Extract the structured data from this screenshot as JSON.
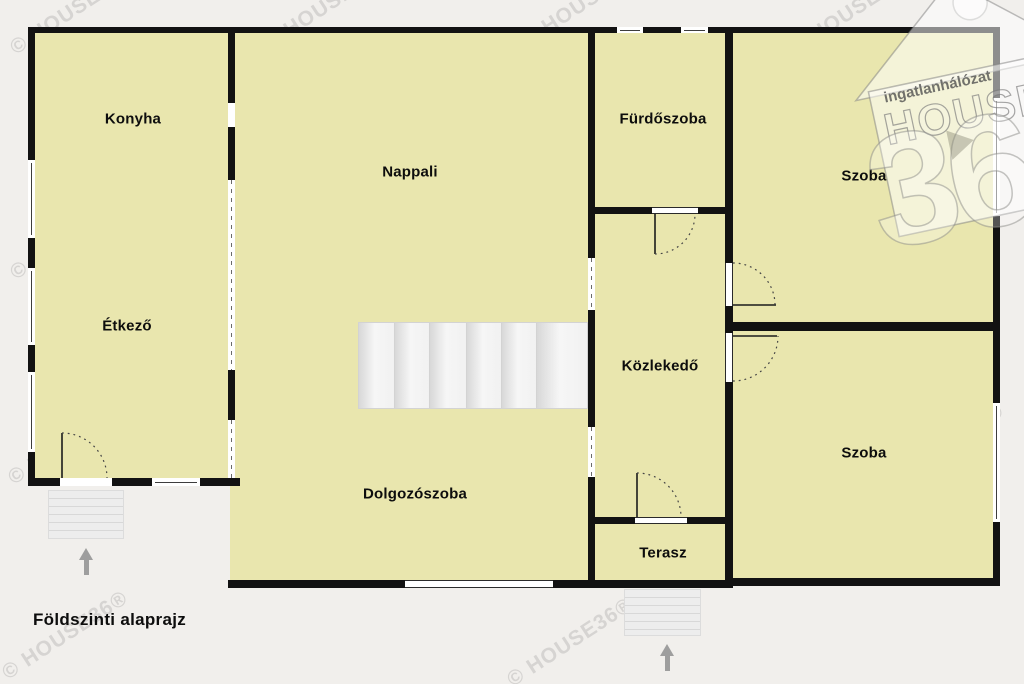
{
  "meta": {
    "plan_title": "Földszinti alaprajz"
  },
  "watermark": {
    "text": "© HOUSE36®"
  },
  "logo": {
    "brand_top": "ingatlanhálózat",
    "brand_main": "HOUSE",
    "brand_number": "36"
  },
  "rooms": [
    {
      "id": "konyha",
      "label": "Konyha"
    },
    {
      "id": "nappali",
      "label": "Nappali"
    },
    {
      "id": "furdoszoba",
      "label": "Fürdőszoba"
    },
    {
      "id": "szoba-felso",
      "label": "Szoba"
    },
    {
      "id": "etkezo",
      "label": "Étkező"
    },
    {
      "id": "kozlekedo",
      "label": "Közlekedő"
    },
    {
      "id": "szoba-also",
      "label": "Szoba"
    },
    {
      "id": "dolgozoszoba",
      "label": "Dolgozószoba"
    },
    {
      "id": "terasz",
      "label": "Terasz"
    }
  ],
  "colors": {
    "background": "#f1efec",
    "room_fill": "#e9e6ae",
    "wall": "#121212",
    "arrow": "#9e9e9e",
    "watermark": "rgba(120,120,120,0.22)"
  }
}
